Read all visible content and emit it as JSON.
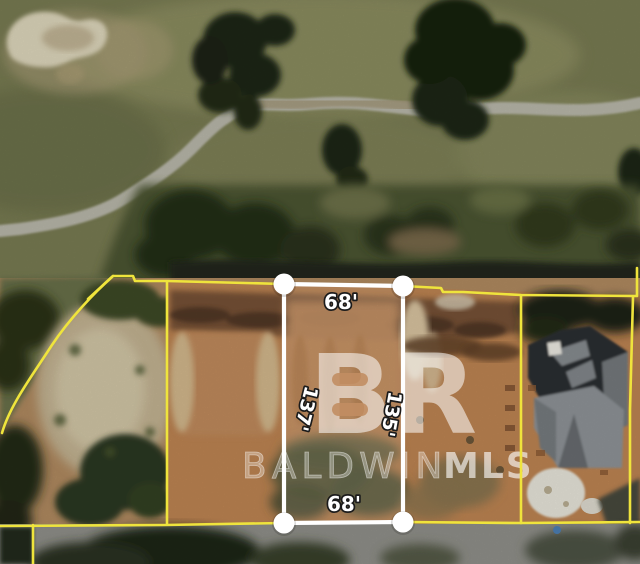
{
  "lot": {
    "top_width_label": "68'",
    "bottom_width_label": "68'",
    "left_depth_label": "137'",
    "right_depth_label": "135'"
  },
  "watermark": {
    "logo_text": "BR",
    "brand_text": "BALDWIN",
    "mls_text": "MLS"
  },
  "colors": {
    "boundary_yellow": "#efe43c",
    "lot_outline_white": "#ffffff",
    "label_text": "#ffffff",
    "label_outline": "#1b1b1b",
    "watermark_white": "#ffffff"
  }
}
